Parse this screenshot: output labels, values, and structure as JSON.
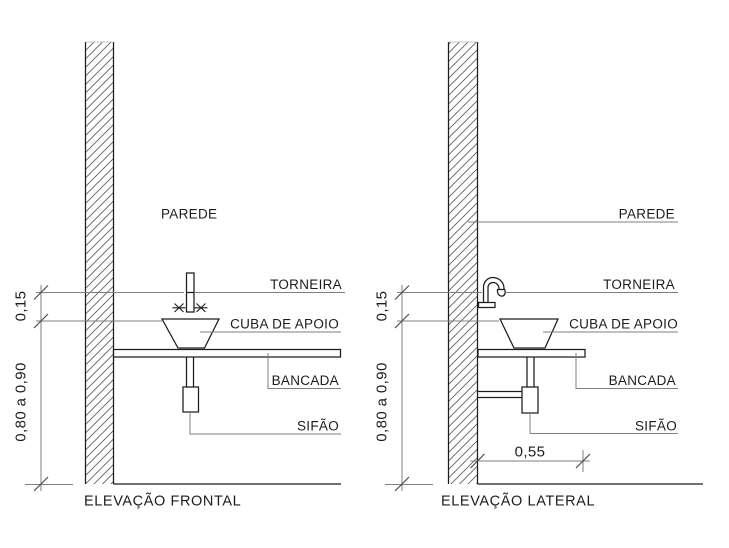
{
  "drawing": {
    "background": "#ffffff",
    "object_line_color": "#1c1c1c",
    "annotation_line_color": "#7f7f7f",
    "text_color": "#1c1c1c"
  },
  "icons": {
    "valve": "x-valve-symbol"
  },
  "front_elevation": {
    "title": "ELEVAÇÃO FRONTAL",
    "labels": {
      "wall": "PAREDE",
      "faucet": "TORNEIRA",
      "basin": "CUBA DE APOIO",
      "countertop": "BANCADA",
      "trap": "SIFÃO"
    },
    "dimensions": {
      "faucet_height": "0,15",
      "countertop_height": "0,80 a 0,90"
    }
  },
  "side_elevation": {
    "title": "ELEVAÇÃO LATERAL",
    "labels": {
      "wall": "PAREDE",
      "faucet": "TORNEIRA",
      "basin": "CUBA DE APOIO",
      "countertop": "BANCADA",
      "trap": "SIFÃO"
    },
    "dimensions": {
      "faucet_height": "0,15",
      "countertop_height": "0,80 a 0,90",
      "countertop_depth": "0,55"
    }
  }
}
